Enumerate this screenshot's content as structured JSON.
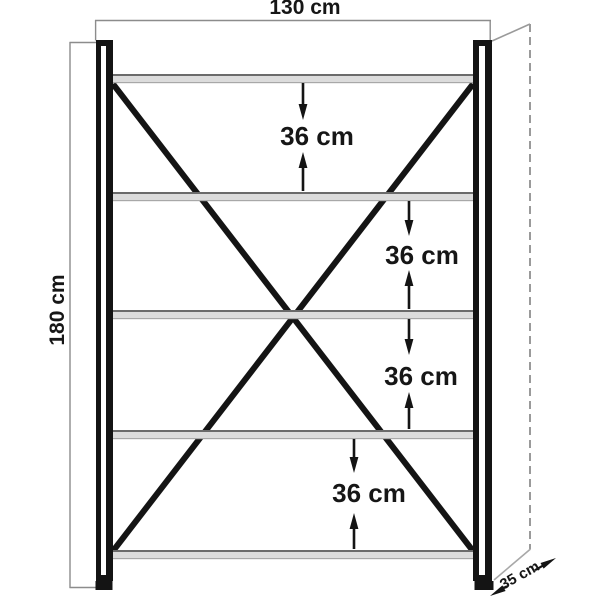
{
  "diagram": {
    "kind": "shelving-unit-dimension-drawing",
    "shelf_count": 5,
    "labels": {
      "width": "130 cm",
      "height": "180 cm",
      "depth": "35 cm",
      "gaps": [
        "36 cm",
        "36 cm",
        "36 cm",
        "36 cm"
      ]
    },
    "colors": {
      "background": "#ffffff",
      "frame": "#141414",
      "dimension_line": "#8c8c8c",
      "perspective_line": "#9a9a9a",
      "shelf_fill": "#dcdcdc",
      "shelf_top_edge": "#6b6b6b",
      "shelf_bottom_edge": "#a8a8a8",
      "text": "#161616"
    }
  }
}
